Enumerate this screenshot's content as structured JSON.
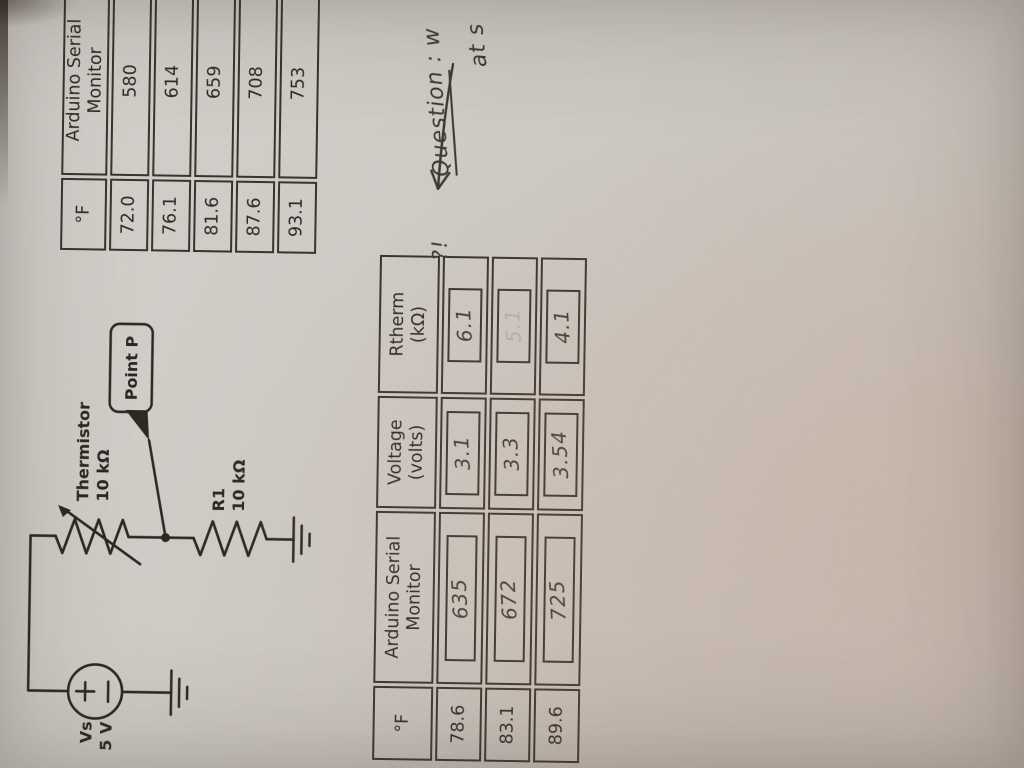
{
  "circuit": {
    "source_name": "Vs",
    "source_value": "5 V",
    "thermistor_name": "Thermistor",
    "thermistor_value": "10 kΩ",
    "r1_name": "R1",
    "r1_value": "10 kΩ",
    "point_label": "Point P"
  },
  "table1": {
    "headers": [
      "°F",
      "Arduino Serial Monitor"
    ],
    "rows": [
      {
        "f": "72.0",
        "adc": "580"
      },
      {
        "f": "76.1",
        "adc": "614"
      },
      {
        "f": "81.6",
        "adc": "659"
      },
      {
        "f": "87.6",
        "adc": "708"
      },
      {
        "f": "93.1",
        "adc": "753"
      }
    ]
  },
  "table2": {
    "headers": {
      "f": "°F",
      "adc": "Arduino Serial Monitor",
      "voltage_line1": "Voltage",
      "voltage_line2": "(volts)",
      "rtherm_line1": "Rtherm",
      "rtherm_line2": "(kΩ)"
    },
    "rows": [
      {
        "f": "78.6",
        "adc": "635",
        "voltage": "3.1",
        "rtherm": "6.1"
      },
      {
        "f": "83.1",
        "adc": "672",
        "voltage": "3.3",
        "rtherm": "5.1"
      },
      {
        "f": "89.6",
        "adc": "725",
        "voltage": "3.54",
        "rtherm": "4.1"
      }
    ]
  },
  "note": {
    "marks": "?!",
    "underlined_word": "Question",
    "line1_rest": " : w",
    "line2": "at s"
  },
  "colors": {
    "paper": "#ccc8c2",
    "ink_print": "#2e2a25",
    "ink_hand": "#3f3932"
  }
}
